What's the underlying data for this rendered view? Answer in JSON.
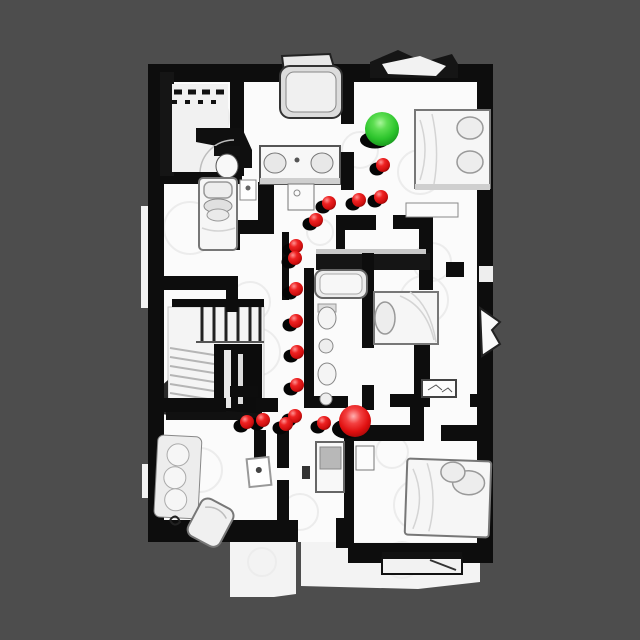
{
  "scene": {
    "background_color": "#4d4d4d",
    "floor_color": "#fbfbfb",
    "wall_color": "#0d0d0d",
    "canvas_width": 640,
    "canvas_height": 640
  },
  "markers": {
    "goal": {
      "name": "goal-sphere",
      "color": "#2cc42c",
      "x": 382,
      "y": 129,
      "radius": 17
    },
    "agent": {
      "name": "agent-sphere",
      "color": "#e01010",
      "x": 355,
      "y": 421,
      "radius": 16
    },
    "waypoint_color": "#e01414",
    "waypoint_radius": 7,
    "waypoints": [
      {
        "x": 383,
        "y": 165
      },
      {
        "x": 381,
        "y": 197
      },
      {
        "x": 359,
        "y": 200
      },
      {
        "x": 329,
        "y": 203
      },
      {
        "x": 316,
        "y": 220
      },
      {
        "x": 296,
        "y": 246
      },
      {
        "x": 295,
        "y": 258
      },
      {
        "x": 296,
        "y": 289
      },
      {
        "x": 296,
        "y": 321
      },
      {
        "x": 297,
        "y": 352
      },
      {
        "x": 297,
        "y": 385
      },
      {
        "x": 295,
        "y": 416
      },
      {
        "x": 286,
        "y": 424
      },
      {
        "x": 263,
        "y": 420
      },
      {
        "x": 247,
        "y": 422
      },
      {
        "x": 324,
        "y": 423
      }
    ]
  }
}
